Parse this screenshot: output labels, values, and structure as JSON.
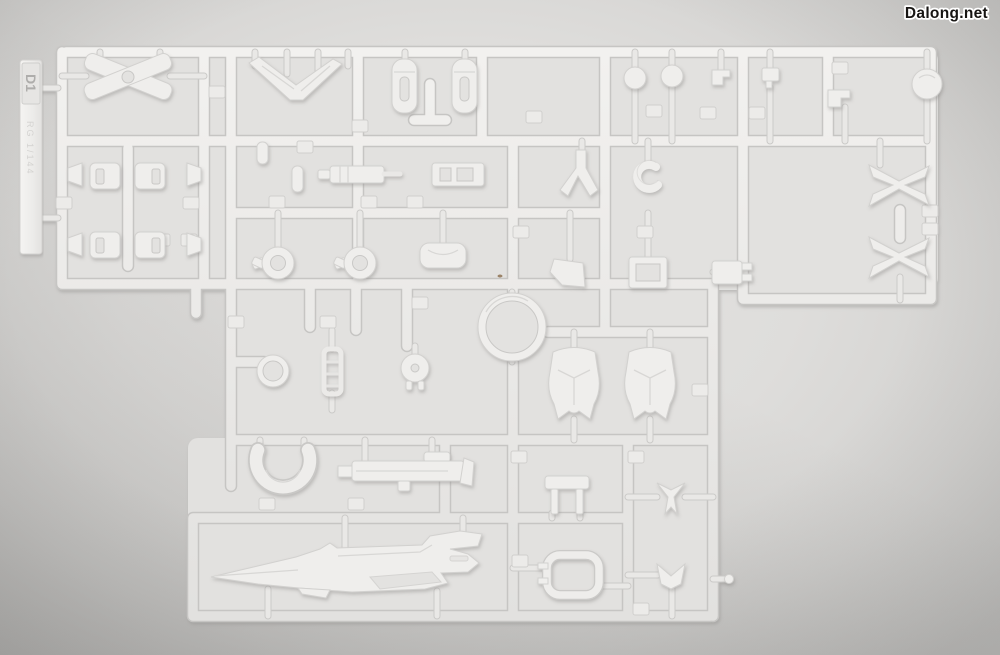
{
  "meta": {
    "description": "Photograph of a white injection-molded plastic model-kit runner (sprue D1) laid on a plain light-gray surface"
  },
  "watermark": {
    "text": "Dalong.net",
    "color": "#171513",
    "halo": "#ffffff"
  },
  "runner": {
    "tag_label": "D1",
    "molded_text": "RG 1/144",
    "plastic_color": "#efeeec",
    "plastic_outline": "#c6c5c3",
    "background_color": "#dedddb",
    "part_names": [
      "x-brace",
      "knee-armor",
      "wing-chevron",
      "foot",
      "ball-joint",
      "shoulder-ring",
      "leg-frame",
      "c-ring",
      "bracket",
      "head-ball",
      "leg-armor-flap",
      "chest-armor",
      "large-ring",
      "small-ring",
      "thruster-pod",
      "frame-ladder",
      "curved-shield",
      "beam-rifle",
      "fork-bracket",
      "v-fin",
      "u-clamp",
      "long-blade"
    ]
  }
}
